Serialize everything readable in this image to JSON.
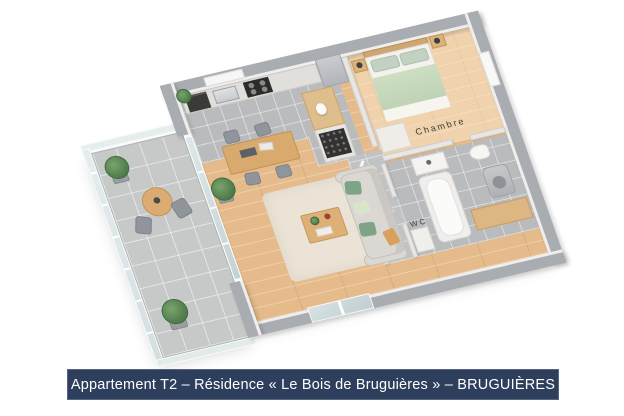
{
  "caption": {
    "text": "Appartement T2 – Résidence « Le Bois de Bruguières » – BRUGUIÈRES"
  },
  "plan": {
    "type": "3d-floorplan",
    "room_labels": {
      "bedroom": "Chambre",
      "toilet": "WC"
    },
    "colors": {
      "caption_bg": "#2e3e5d",
      "caption_text": "#ffffff",
      "wall": "#a9adb2",
      "wood_floor": "#e6bb8b",
      "tile_floor": "#b9bbbd",
      "balcony_tile": "#c7c9c8",
      "rug": "#ebe4d6",
      "sofa": "#dbd8d3",
      "cushion_green": "#7fa386",
      "bed_green": "#cddec3"
    }
  }
}
